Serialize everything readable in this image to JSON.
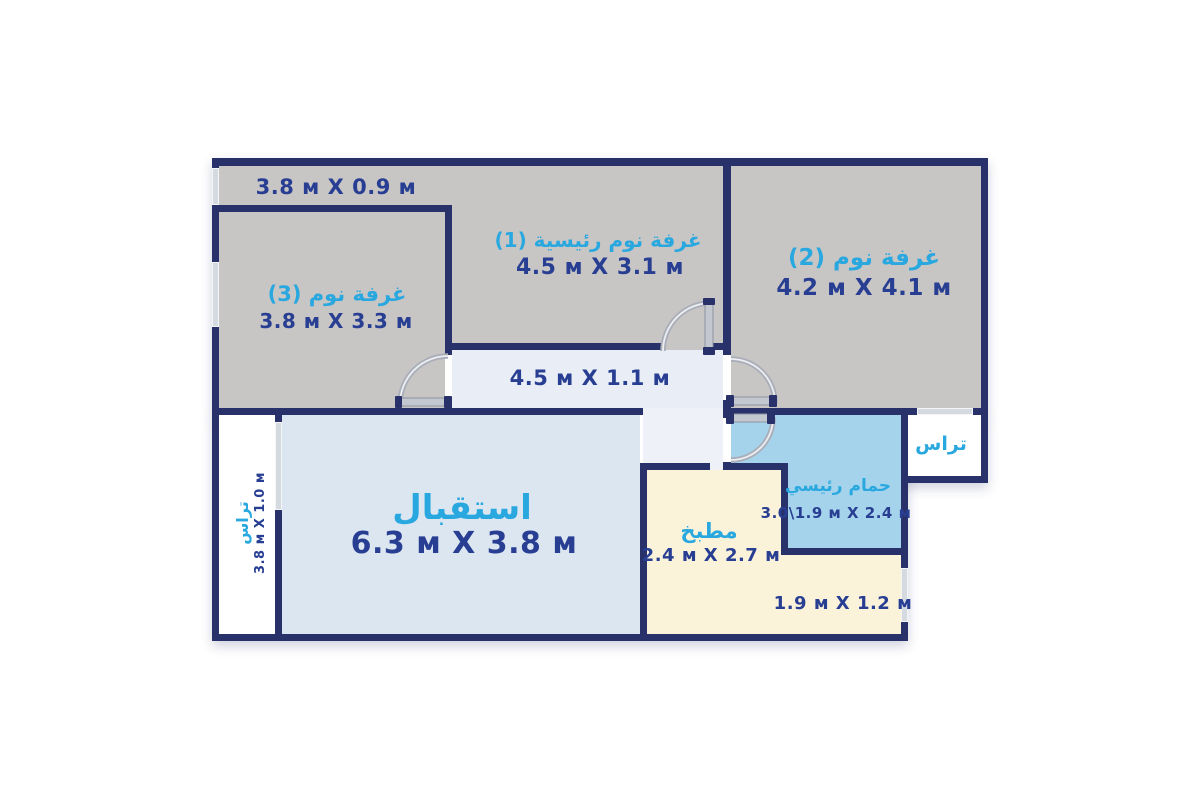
{
  "palette": {
    "wall": "#283169",
    "room_gray": "#c8c5c5",
    "corridor_fill": "#e9eef6",
    "hall_fill": "#eef2f8",
    "reception_fill": "#dce6f0",
    "kitchen_fill": "#faf3da",
    "bath_fill": "#a5d3eb",
    "terrace_fill": "#ffffff",
    "name_color": "#29a8e0",
    "dim_color": "#273e92",
    "door_metal": "#b4b8c2",
    "window_glass": "#d5dae0"
  },
  "rooms": {
    "balcony_top": {
      "dims": "3.8 м X 0.9 м"
    },
    "bedroom1": {
      "name": "غرفة نوم رئيسية (1)",
      "dims": "4.5 м X 3.1 м"
    },
    "bedroom2": {
      "name": "غرفة نوم (2)",
      "dims": "4.2 м X 4.1 м"
    },
    "bedroom3": {
      "name": "غرفة نوم (3)",
      "dims": "3.8 м X 3.3 м"
    },
    "corridor": {
      "dims": "4.5 м X 1.1 м"
    },
    "reception": {
      "name": "استقبال",
      "dims": "6.3 м X 3.8 м"
    },
    "kitchen": {
      "name": "مطبخ",
      "dims": "2.4 м X 2.7 м"
    },
    "master_bathroom": {
      "name": "حمام رئيسي",
      "dims": "3.0\\1.9 м X 2.4 м"
    },
    "terrace_left": {
      "name": "تراس",
      "dims": "3.8 м X 1.0 м"
    },
    "terrace_right": {
      "name": "تراس"
    },
    "nook": {
      "dims": "1.9 м X 1.2 м"
    }
  }
}
